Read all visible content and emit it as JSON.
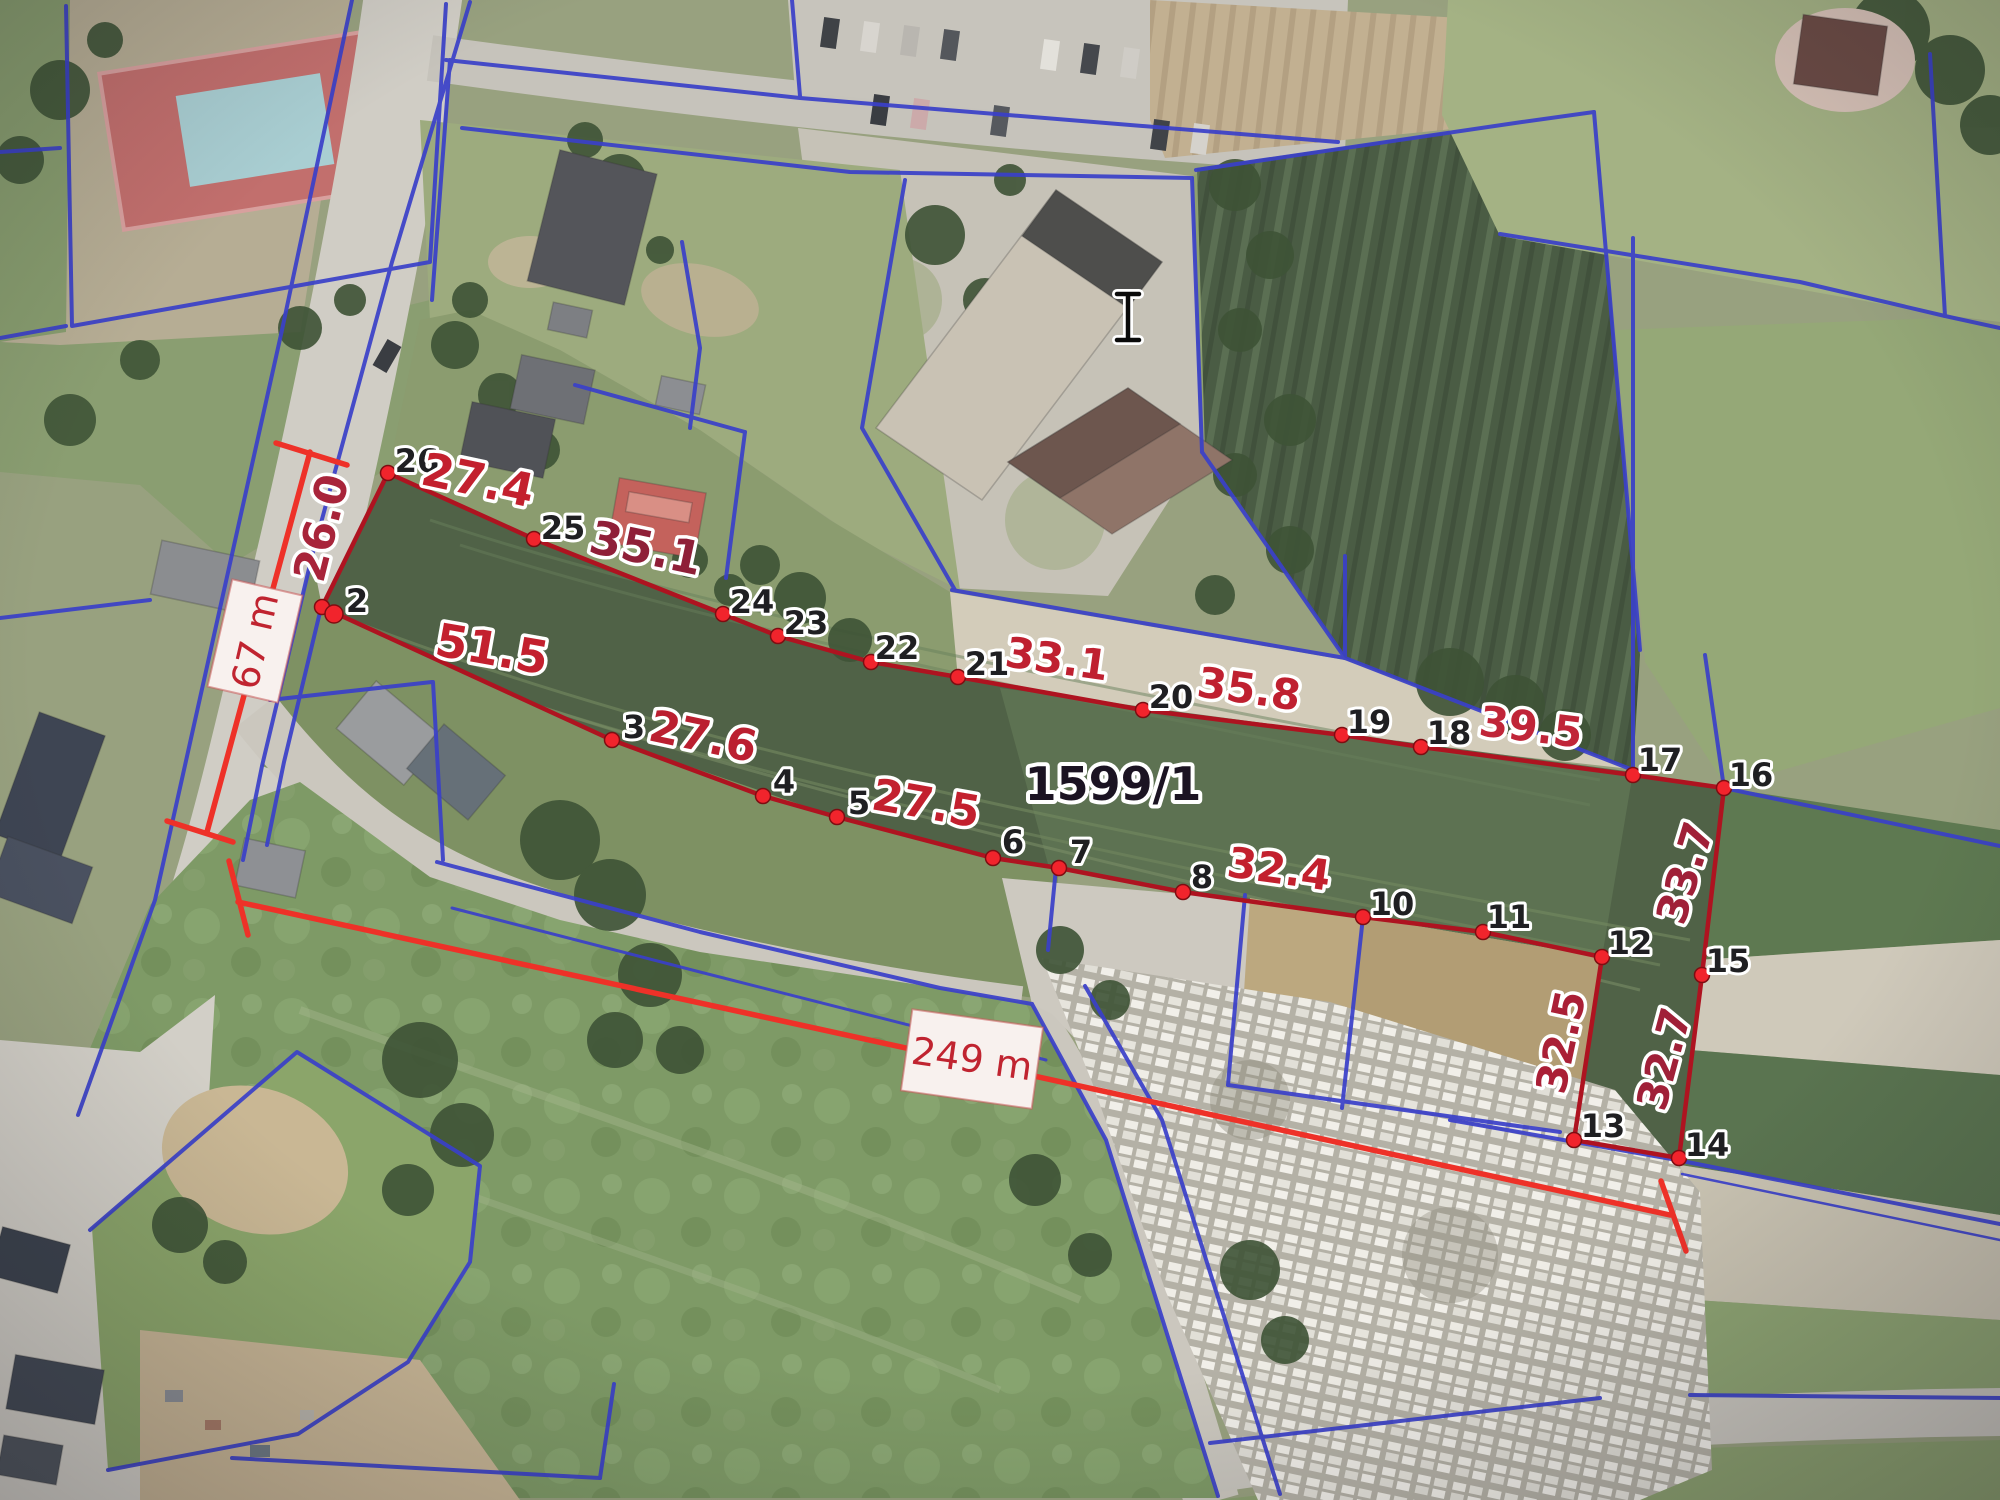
{
  "map": {
    "type": "cadastral-aerial-viewer",
    "parcel": {
      "number": "1599/1",
      "number_pos": {
        "x": 1113,
        "y": 800
      },
      "number_color": "#1b1322",
      "number_size": 46
    },
    "colors": {
      "boundary_red": "#ae1320",
      "vertex_red": "#f1242c",
      "vertex_edge": "#7e0d12",
      "measure_red": "#ee3128",
      "measure_text": "#c02430",
      "cadastral_blue": "#3a40c9",
      "vertex_label": "#1f1f22",
      "label_halo": "#ffffff"
    },
    "vertices": [
      {
        "n": "26",
        "x": 388,
        "y": 473,
        "lx": 417,
        "ly": 461
      },
      {
        "n": "2",
        "x": 322,
        "y": 607,
        "lx": 357,
        "ly": 601
      },
      {
        "n": "3",
        "x": 612,
        "y": 740,
        "lx": 634,
        "ly": 727
      },
      {
        "n": "4",
        "x": 763,
        "y": 796,
        "lx": 784,
        "ly": 782
      },
      {
        "n": "5",
        "x": 837,
        "y": 817,
        "lx": 859,
        "ly": 803
      },
      {
        "n": "6",
        "x": 993,
        "y": 858,
        "lx": 1013,
        "ly": 842
      },
      {
        "n": "7",
        "x": 1059,
        "y": 868,
        "lx": 1081,
        "ly": 852
      },
      {
        "n": "8",
        "x": 1183,
        "y": 892,
        "lx": 1202,
        "ly": 877
      },
      {
        "n": "10",
        "x": 1363,
        "y": 917,
        "lx": 1392,
        "ly": 904
      },
      {
        "n": "11",
        "x": 1483,
        "y": 932,
        "lx": 1509,
        "ly": 917
      },
      {
        "n": "12",
        "x": 1602,
        "y": 957,
        "lx": 1630,
        "ly": 943
      },
      {
        "n": "13",
        "x": 1574,
        "y": 1140,
        "lx": 1603,
        "ly": 1126
      },
      {
        "n": "14",
        "x": 1679,
        "y": 1158,
        "lx": 1707,
        "ly": 1145
      },
      {
        "n": "15",
        "x": 1702,
        "y": 975,
        "lx": 1728,
        "ly": 961
      },
      {
        "n": "16",
        "x": 1724,
        "y": 788,
        "lx": 1751,
        "ly": 775
      },
      {
        "n": "17",
        "x": 1633,
        "y": 775,
        "lx": 1660,
        "ly": 760
      },
      {
        "n": "18",
        "x": 1421,
        "y": 747,
        "lx": 1449,
        "ly": 733
      },
      {
        "n": "19",
        "x": 1342,
        "y": 735,
        "lx": 1369,
        "ly": 722
      },
      {
        "n": "20",
        "x": 1143,
        "y": 710,
        "lx": 1171,
        "ly": 697
      },
      {
        "n": "21",
        "x": 958,
        "y": 677,
        "lx": 987,
        "ly": 664
      },
      {
        "n": "22",
        "x": 871,
        "y": 662,
        "lx": 897,
        "ly": 648
      },
      {
        "n": "23",
        "x": 778,
        "y": 636,
        "lx": 806,
        "ly": 623
      },
      {
        "n": "24",
        "x": 723,
        "y": 614,
        "lx": 752,
        "ly": 602
      },
      {
        "n": "25",
        "x": 534,
        "y": 539,
        "lx": 563,
        "ly": 528
      }
    ],
    "extra_vertex_dot": {
      "x": 334,
      "y": 614
    },
    "segment_labels": [
      {
        "text": "26.0",
        "x": 322,
        "y": 528,
        "rot": -76,
        "size": 44,
        "color": "#a8243a"
      },
      {
        "text": "27.4",
        "x": 478,
        "y": 480,
        "rot": 12,
        "size": 46,
        "color": "#c3202e"
      },
      {
        "text": "35.1",
        "x": 646,
        "y": 548,
        "rot": 12,
        "size": 46,
        "color": "#8f1f38"
      },
      {
        "text": "51.5",
        "x": 492,
        "y": 649,
        "rot": 10,
        "size": 46,
        "color": "#c3202e"
      },
      {
        "text": "27.6",
        "x": 703,
        "y": 737,
        "rot": 12,
        "size": 44,
        "color": "#bb1f30"
      },
      {
        "text": "27.5",
        "x": 926,
        "y": 804,
        "rot": 10,
        "size": 44,
        "color": "#c3202e"
      },
      {
        "text": "33.1",
        "x": 1057,
        "y": 659,
        "rot": 8,
        "size": 42,
        "color": "#bf2030"
      },
      {
        "text": "35.8",
        "x": 1249,
        "y": 689,
        "rot": 8,
        "size": 42,
        "color": "#bf2030"
      },
      {
        "text": "39.5",
        "x": 1531,
        "y": 727,
        "rot": 7,
        "size": 42,
        "color": "#c02538"
      },
      {
        "text": "32.4",
        "x": 1279,
        "y": 869,
        "rot": 8,
        "size": 42,
        "color": "#c3202e"
      },
      {
        "text": "33.7",
        "x": 1685,
        "y": 873,
        "rot": -73,
        "size": 42,
        "color": "#a02038"
      },
      {
        "text": "32.5",
        "x": 1561,
        "y": 1042,
        "rot": -78,
        "size": 42,
        "color": "#aa1f36"
      },
      {
        "text": "32.7",
        "x": 1664,
        "y": 1059,
        "rot": -75,
        "size": 42,
        "color": "#a02038"
      }
    ],
    "measurements": [
      {
        "id": "width-67m",
        "label": "67 m",
        "line": [
          310,
          452,
          207,
          832
        ],
        "tick1": [
          276,
          443,
          347,
          465
        ],
        "tick2": [
          167,
          821,
          233,
          842
        ],
        "box": {
          "cx": 255,
          "cy": 641,
          "w": 110,
          "h": 72,
          "rot": -77
        },
        "text_size": 38
      },
      {
        "id": "length-249m",
        "label": "249 m",
        "line": [
          238,
          902,
          1670,
          1215
        ],
        "tick1": [
          229,
          861,
          248,
          935
        ],
        "tick2": [
          1661,
          1181,
          1686,
          1251
        ],
        "box": {
          "cx": 972,
          "cy": 1059,
          "w": 132,
          "h": 82,
          "rot": 8
        },
        "text_size": 38
      }
    ],
    "cursor": {
      "name": "text-cursor",
      "x": 1128,
      "y": 317
    }
  }
}
